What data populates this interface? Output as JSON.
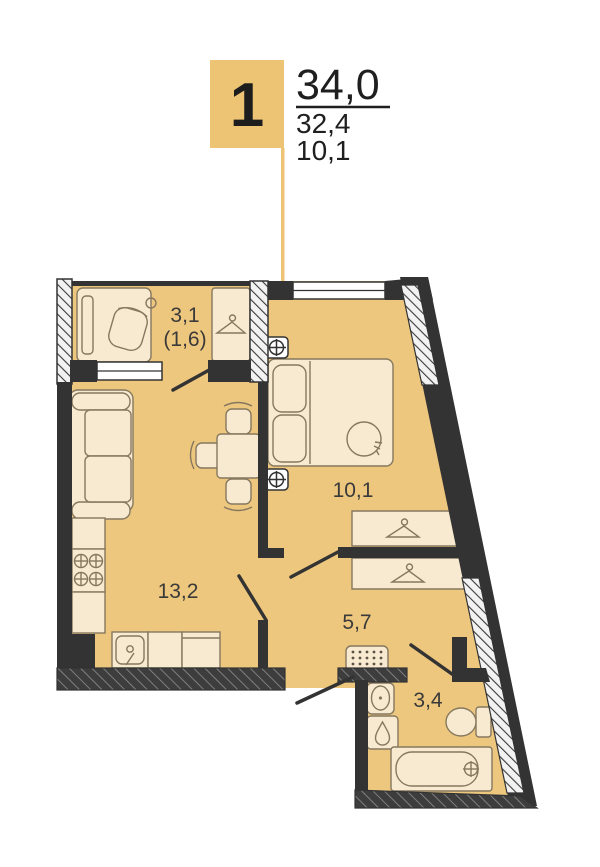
{
  "header": {
    "unit_number": "1",
    "area_total": "34,0",
    "area_living": "32,4",
    "area_kitchen": "10,1"
  },
  "rooms": {
    "loggia": {
      "area": "3,1",
      "area_reduced": "(1,6)"
    },
    "bedroom": {
      "area": "10,1"
    },
    "living_kitchen": {
      "area": "13,2"
    },
    "hallway": {
      "area": "5,7"
    },
    "bathroom": {
      "area": "3,4"
    }
  },
  "icons": [
    "hanger-icon",
    "stove-burners-icon",
    "kitchen-sink-icon",
    "outlet-icon",
    "bed-icon",
    "sofa-icon",
    "dining-table-icon",
    "desk-chair-icon",
    "doormat-icon",
    "bath-sink-icon",
    "water-drop-icon",
    "toilet-icon",
    "bathtub-icon",
    "faucet-icon",
    "door-swing-icon",
    "window-icon"
  ],
  "colors": {
    "accent": "#ecc474",
    "floor": "#eec77e",
    "furniture": "#f8ead0",
    "furnstroke": "#85785f",
    "wall": "#333333",
    "ink": "#1f1f1f"
  }
}
